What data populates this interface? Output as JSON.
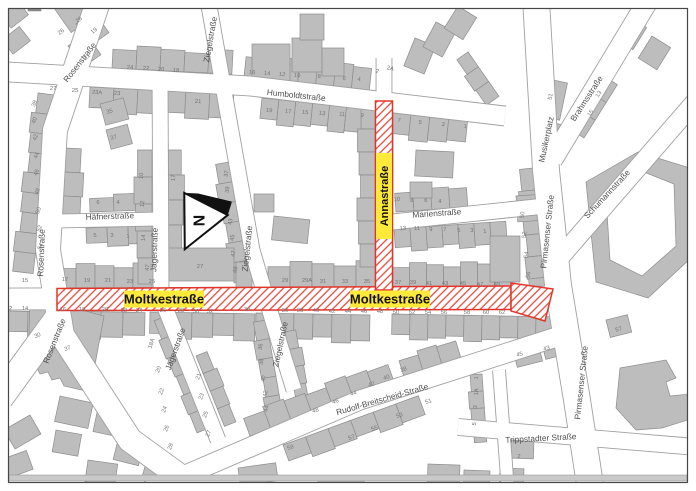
{
  "map_title": "Stadtplan Ausschnitt",
  "highlighted_streets": [
    "Annastraße",
    "Moltkestraße"
  ],
  "colors": {
    "background": "#ffffff",
    "frame": "#474747",
    "building_fill": "#bdbdbd",
    "building_stroke": "#8d8d8d",
    "building_dark": "#8a8a8a",
    "street_line": "#a0a0a0",
    "street_fill": "#ffffff",
    "highlight_red": "#e2352a",
    "highlight_yellow": "#ffe93b",
    "street_label": "#4f4f4f",
    "house_number": "#757575",
    "north_arrow": "#111111"
  },
  "north_arrow": {
    "label": "N"
  },
  "street_labels": [
    {
      "name": "rosenstrasse-top",
      "text": "Rosenstraße",
      "x": 82,
      "y": 64,
      "rot": -52,
      "style": "plain"
    },
    {
      "name": "ziegelstrasse-top",
      "text": "Ziegelstraße",
      "x": 213,
      "y": 40,
      "rot": -80,
      "style": "plain"
    },
    {
      "name": "humboldtstrasse",
      "text": "Humboldtstraße",
      "x": 296,
      "y": 98,
      "rot": 6,
      "style": "plain"
    },
    {
      "name": "rosenstrasse-mid",
      "text": "Rosenstraße",
      "x": 44,
      "y": 253,
      "rot": -88,
      "style": "plain"
    },
    {
      "name": "jaegerstrasse",
      "text": "Jägerstraße",
      "x": 157,
      "y": 250,
      "rot": -88,
      "style": "plain"
    },
    {
      "name": "haefnerstrasse",
      "text": "Häfnerstraße",
      "x": 110,
      "y": 219,
      "rot": -2,
      "style": "plain"
    },
    {
      "name": "ziegelstrasse-mid",
      "text": "Ziegelstraße",
      "x": 250,
      "y": 249,
      "rot": -84,
      "style": "plain"
    },
    {
      "name": "annastrasse",
      "text": "Annastraße",
      "x": 384,
      "y": 196,
      "rot": -90,
      "style": "yellow-v"
    },
    {
      "name": "marienstrasse",
      "text": "Marienstraße",
      "x": 437,
      "y": 216,
      "rot": -4,
      "style": "plain"
    },
    {
      "name": "moltkestrasse-west",
      "text": "Moltkestraße",
      "x": 164,
      "y": 299,
      "rot": 0,
      "style": "yellow-h"
    },
    {
      "name": "moltkestrasse-east",
      "text": "Moltkestraße",
      "x": 390,
      "y": 299,
      "rot": 0,
      "style": "yellow-h"
    },
    {
      "name": "pirmasenser-strasse-north",
      "text": "Pirmasenser Straße",
      "x": 550,
      "y": 232,
      "rot": -84,
      "style": "plain"
    },
    {
      "name": "musikerplatz",
      "text": "Musikerplatz",
      "x": 549,
      "y": 140,
      "rot": -78,
      "style": "plain"
    },
    {
      "name": "brahmsstrasse",
      "text": "Brahmsstraße",
      "x": 589,
      "y": 100,
      "rot": -57,
      "style": "plain"
    },
    {
      "name": "schumannstrasse",
      "text": "Schumannstraße",
      "x": 609,
      "y": 196,
      "rot": -47,
      "style": "plain"
    },
    {
      "name": "rosenstrasse-south",
      "text": "Rosenstraße",
      "x": 57,
      "y": 342,
      "rot": -68,
      "style": "plain"
    },
    {
      "name": "jaegerstrasse-south",
      "text": "Jägerstraße",
      "x": 178,
      "y": 350,
      "rot": -70,
      "style": "plain"
    },
    {
      "name": "ziegelstrasse-south",
      "text": "Ziegelstraße",
      "x": 283,
      "y": 345,
      "rot": -78,
      "style": "plain"
    },
    {
      "name": "rudolf-breitscheid-strasse",
      "text": "Rudolf-Breitscheid-Straße",
      "x": 383,
      "y": 402,
      "rot": -16,
      "style": "plain"
    },
    {
      "name": "pirmasenser-strasse-south",
      "text": "Pirmasenser Straße",
      "x": 584,
      "y": 383,
      "rot": -84,
      "style": "plain"
    },
    {
      "name": "trippstadter-strasse",
      "text": "Trippstadter Straße",
      "x": 541,
      "y": 441,
      "rot": -3,
      "style": "plain"
    }
  ],
  "house_numbers": [
    [
      "24",
      130,
      69,
      3
    ],
    [
      "22",
      146,
      70,
      3
    ],
    [
      "20",
      161,
      71,
      3
    ],
    [
      "18",
      176,
      72,
      3
    ],
    [
      "16",
      252,
      74,
      6
    ],
    [
      "14",
      267,
      75,
      6
    ],
    [
      "12",
      282,
      76,
      6
    ],
    [
      "10",
      297,
      77,
      6
    ],
    [
      "8",
      319,
      78,
      6
    ],
    [
      "6",
      344,
      80,
      6
    ],
    [
      "4",
      359,
      81,
      6
    ],
    [
      "2",
      377,
      73,
      10
    ],
    [
      "2A",
      390,
      70,
      14
    ],
    [
      "27",
      53,
      90,
      3
    ],
    [
      "25",
      75,
      92,
      3
    ],
    [
      "23A",
      97,
      94,
      3
    ],
    [
      "23",
      117,
      95,
      3
    ],
    [
      "21",
      198,
      103,
      4
    ],
    [
      "19",
      269,
      112,
      6
    ],
    [
      "17",
      288,
      113,
      6
    ],
    [
      "15",
      305,
      114,
      6
    ],
    [
      "13",
      322,
      115,
      6
    ],
    [
      "11",
      342,
      116,
      6
    ],
    [
      "9",
      362,
      117,
      6
    ],
    [
      "7",
      399,
      122,
      6
    ],
    [
      "5",
      420,
      124,
      6
    ],
    [
      "3",
      443,
      126,
      6
    ],
    [
      "1",
      465,
      128,
      6
    ],
    [
      "26",
      62,
      33,
      -38
    ],
    [
      "28",
      80,
      21,
      -38
    ],
    [
      "19",
      95,
      32,
      -38
    ],
    [
      "21",
      88,
      58,
      -38
    ],
    [
      "38",
      36,
      104,
      -70
    ],
    [
      "40",
      36,
      121,
      -70
    ],
    [
      "42",
      37,
      138,
      -70
    ],
    [
      "44",
      38,
      156,
      -70
    ],
    [
      "46",
      38,
      173,
      -70
    ],
    [
      "48",
      39,
      192,
      -70
    ],
    [
      "50",
      40,
      211,
      -70
    ],
    [
      "52",
      41,
      229,
      -70
    ],
    [
      "54",
      42,
      247,
      -70
    ],
    [
      "35",
      110,
      113,
      -15
    ],
    [
      "37",
      114,
      139,
      -15
    ],
    [
      "47",
      149,
      268,
      -80
    ],
    [
      "15",
      25,
      282,
      0
    ],
    [
      "30",
      38,
      337,
      -20
    ],
    [
      "37",
      68,
      350,
      -20
    ],
    [
      "6",
      98,
      204,
      0
    ],
    [
      "4",
      118,
      204,
      0
    ],
    [
      "5",
      95,
      237,
      0
    ],
    [
      "3",
      112,
      237,
      0
    ],
    [
      "1",
      128,
      238,
      0
    ],
    [
      "10",
      143,
      176,
      -85
    ],
    [
      "12",
      144,
      204,
      -85
    ],
    [
      "14",
      145,
      238,
      -85
    ],
    [
      "17",
      175,
      178,
      -85
    ],
    [
      "37",
      228,
      174,
      -80
    ],
    [
      "39",
      229,
      190,
      -80
    ],
    [
      "41",
      231,
      206,
      -80
    ],
    [
      "43",
      232,
      222,
      -80
    ],
    [
      "45",
      234,
      238,
      -80
    ],
    [
      "47",
      235,
      254,
      -80
    ],
    [
      "49",
      237,
      270,
      -80
    ],
    [
      "17",
      65,
      281,
      0
    ],
    [
      "19",
      87,
      282,
      0
    ],
    [
      "21",
      108,
      282,
      0
    ],
    [
      "23",
      130,
      283,
      0
    ],
    [
      "25",
      152,
      283,
      0
    ],
    [
      "27",
      200,
      268,
      0
    ],
    [
      "29",
      285,
      282,
      0
    ],
    [
      "29A",
      307,
      282,
      0
    ],
    [
      "31",
      323,
      283,
      0
    ],
    [
      "33",
      345,
      283,
      0
    ],
    [
      "35",
      367,
      283,
      0
    ],
    [
      "37",
      398,
      284,
      0
    ],
    [
      "39",
      413,
      284,
      0
    ],
    [
      "41",
      429,
      285,
      0
    ],
    [
      "43",
      445,
      285,
      0
    ],
    [
      "45",
      463,
      285,
      0
    ],
    [
      "47",
      480,
      286,
      0
    ],
    [
      "49",
      497,
      286,
      0
    ],
    [
      "12",
      9,
      310,
      0
    ],
    [
      "14",
      25,
      310,
      0
    ],
    [
      "16",
      63,
      311,
      0
    ],
    [
      "18",
      82,
      311,
      0
    ],
    [
      "20",
      105,
      311,
      0
    ],
    [
      "22",
      124,
      312,
      0
    ],
    [
      "24",
      139,
      312,
      0
    ],
    [
      "26",
      163,
      312,
      0
    ],
    [
      "28",
      181,
      312,
      0
    ],
    [
      "30",
      196,
      313,
      0
    ],
    [
      "32",
      210,
      313,
      0
    ],
    [
      "34",
      247,
      311,
      0
    ],
    [
      "36",
      285,
      312,
      0
    ],
    [
      "38",
      300,
      312,
      0
    ],
    [
      "40",
      316,
      312,
      0
    ],
    [
      "42",
      332,
      313,
      0
    ],
    [
      "44",
      348,
      313,
      0
    ],
    [
      "46",
      364,
      313,
      0
    ],
    [
      "48",
      380,
      313,
      0
    ],
    [
      "50",
      396,
      314,
      0
    ],
    [
      "52",
      412,
      314,
      0
    ],
    [
      "54",
      428,
      314,
      0
    ],
    [
      "56",
      444,
      314,
      0
    ],
    [
      "58",
      467,
      314,
      0
    ],
    [
      "60",
      486,
      314,
      0
    ],
    [
      "62",
      502,
      314,
      0
    ],
    [
      "10",
      397,
      201,
      -4
    ],
    [
      "8",
      412,
      202,
      -4
    ],
    [
      "6",
      426,
      202,
      -4
    ],
    [
      "4",
      440,
      203,
      -4
    ],
    [
      "13",
      403,
      230,
      -4
    ],
    [
      "11",
      417,
      230,
      -4
    ],
    [
      "9",
      431,
      231,
      -4
    ],
    [
      "7",
      445,
      231,
      -4
    ],
    [
      "5",
      459,
      232,
      -4
    ],
    [
      "3",
      472,
      232,
      -4
    ],
    [
      "1",
      485,
      233,
      -4
    ],
    [
      "50",
      524,
      215,
      -82
    ],
    [
      "52",
      526,
      235,
      -82
    ],
    [
      "54",
      528,
      255,
      -82
    ],
    [
      "56",
      530,
      275,
      -82
    ],
    [
      "51",
      552,
      97,
      -78
    ],
    [
      "13",
      600,
      95,
      -58
    ],
    [
      "15",
      592,
      114,
      -58
    ],
    [
      "48",
      316,
      412,
      -18
    ],
    [
      "46",
      336,
      403,
      -18
    ],
    [
      "44",
      354,
      395,
      -18
    ],
    [
      "42",
      372,
      386,
      -18
    ],
    [
      "40",
      387,
      379,
      -18
    ],
    [
      "38",
      404,
      371,
      -18
    ],
    [
      "59",
      291,
      449,
      -18
    ],
    [
      "57",
      352,
      439,
      -18
    ],
    [
      "55",
      375,
      430,
      -18
    ],
    [
      "53",
      400,
      417,
      -18
    ],
    [
      "51",
      429,
      403,
      -18
    ],
    [
      "18A",
      153,
      344,
      -70
    ],
    [
      "20",
      160,
      370,
      -70
    ],
    [
      "22",
      163,
      392,
      -70
    ],
    [
      "24",
      166,
      410,
      -70
    ],
    [
      "26",
      168,
      429,
      -70
    ],
    [
      "28",
      172,
      447,
      -70
    ],
    [
      "21",
      200,
      377,
      -70
    ],
    [
      "23",
      203,
      397,
      -70
    ],
    [
      "25",
      207,
      415,
      -70
    ],
    [
      "27",
      210,
      434,
      -70
    ],
    [
      "36",
      262,
      347,
      -80
    ],
    [
      "38",
      263,
      362,
      -80
    ],
    [
      "40",
      265,
      379,
      -80
    ],
    [
      "42",
      267,
      394,
      -80
    ],
    [
      "44",
      268,
      409,
      -80
    ],
    [
      "43",
      547,
      350,
      -14
    ],
    [
      "45",
      520,
      356,
      -14
    ],
    [
      "57",
      619,
      331,
      -14
    ],
    [
      "1",
      478,
      378,
      -85
    ],
    [
      "1A",
      478,
      392,
      -85
    ],
    [
      "3",
      477,
      407,
      -85
    ],
    [
      "5",
      476,
      424,
      -85
    ],
    [
      "2",
      519,
      458,
      0
    ]
  ]
}
